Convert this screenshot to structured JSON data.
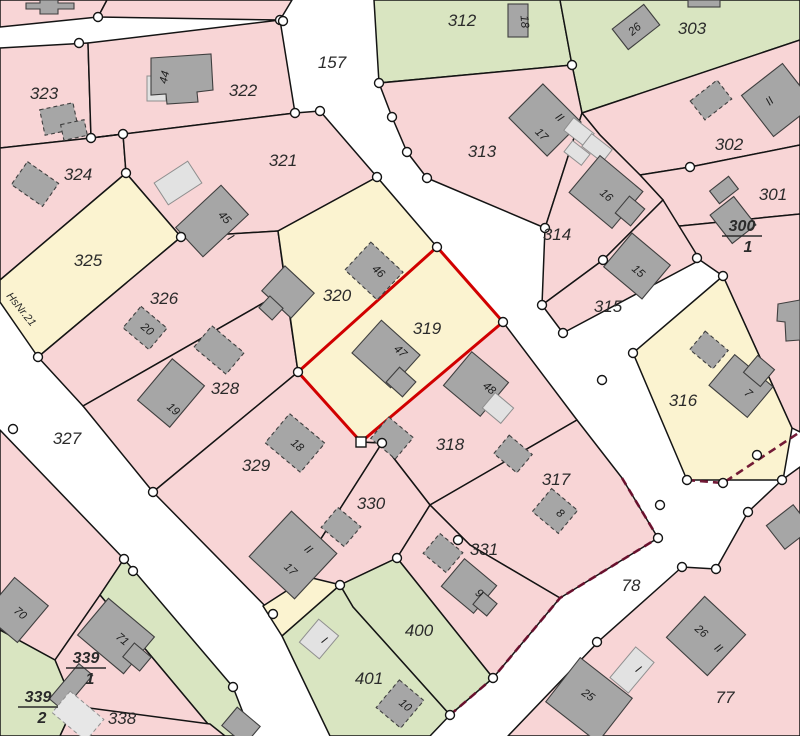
{
  "roads": {
    "r157": "157",
    "r327": "327",
    "r78": "78"
  },
  "parcels": {
    "p312": "312",
    "p303": "303",
    "p323": "323",
    "p322": "322",
    "p321": "321",
    "p313": "313",
    "p302": "302",
    "p301": "301",
    "p324": "324",
    "p325": "325",
    "p326": "326",
    "p320": "320",
    "p319": "319",
    "p314": "314",
    "p315": "315",
    "p316": "316",
    "p328": "328",
    "p329": "329",
    "p318": "318",
    "p317": "317",
    "p330": "330",
    "p331": "331",
    "p338": "338",
    "p400": "400",
    "p401": "401",
    "p77": "77"
  },
  "fractions": {
    "p300_1": {
      "num": "300",
      "den": "1"
    },
    "p339_1": {
      "num": "339",
      "den": "1"
    },
    "p339_2": {
      "num": "339",
      "den": "2"
    }
  },
  "buildings": {
    "n44": "44",
    "n45": "45",
    "n46": "46",
    "n47": "47",
    "n48": "48",
    "n18a": "18",
    "n26a": "26",
    "n17a": "17",
    "n16": "16",
    "n15": "15",
    "n7": "7",
    "n20": "20",
    "n19": "19",
    "n18b": "18",
    "n17b": "17",
    "n8": "8",
    "n9": "9",
    "n10": "10",
    "n25": "25",
    "n26b": "26",
    "n70": "70",
    "n71": "71"
  },
  "storey_marks": {
    "i45": "I",
    "ii313": "II",
    "ii302": "II",
    "ii330": "II",
    "ii77": "II",
    "i401": "I",
    "i77": "I"
  },
  "annotations": {
    "hsnr": "HsNr.21"
  },
  "highlighted_parcel": "319",
  "colors": {
    "parcel_pink": "#f8d5d6",
    "parcel_yellow": "#fbf3d0",
    "parcel_green": "#d9e5c1",
    "road_white": "#ffffff",
    "building_gray": "#a6a6a6",
    "building_light": "#e2e2e2",
    "boundary_black": "#141414",
    "highlight_red": "#d10000",
    "edge_maroon": "#6b0f2d"
  }
}
